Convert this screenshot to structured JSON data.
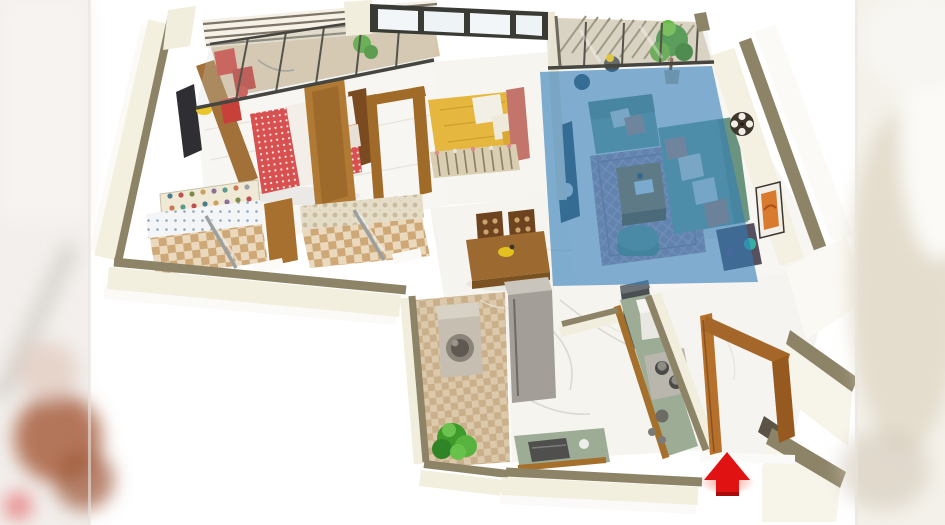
{
  "scene": {
    "description": "3D isometric floor-plan render of a two-bedroom apartment; the living room is shaded with a translucent blue selection overlay and a red 3D arrow marks the main entrance at the bottom right",
    "highlight": {
      "target_room": "living-room",
      "color": "#2e7cb8",
      "opacity": "0.6"
    },
    "entrance": {
      "marker": "red-arrow-up",
      "color": "#e01212"
    },
    "rooms": {
      "master_bedroom": {
        "label": "Master Bedroom"
      },
      "master_balcony": {
        "label": "Bedroom Balcony Sit-out"
      },
      "bedroom2": {
        "label": "Bedroom 2"
      },
      "living_room": {
        "label": "Living Room"
      },
      "living_balcony": {
        "label": "Living Room Balcony"
      },
      "dining": {
        "label": "Dining Area"
      },
      "bathroom_common": {
        "label": "Common Bathroom"
      },
      "bathroom_attached": {
        "label": "Attached Bathroom"
      },
      "kitchen": {
        "label": "Kitchen"
      },
      "utility": {
        "label": "Utility Dry Balcony"
      },
      "entrance_foyer": {
        "label": "Entrance Foyer"
      }
    },
    "palette": {
      "canvas": "#ffffff",
      "wall_top": "#8d8468",
      "wall_face": "#f3efdf",
      "floor_marble": "#f7f6f2",
      "wood": "#b0762f",
      "sofa_green": "#7da793",
      "bed_red_pattern": "#d85050",
      "bed_yellow": "#e5b73e",
      "rug_mauve": "#b18fa0",
      "kitchen_counter": "#9dac95",
      "glass_frame": "#46453f",
      "plant_green": "#4aa32e"
    }
  }
}
